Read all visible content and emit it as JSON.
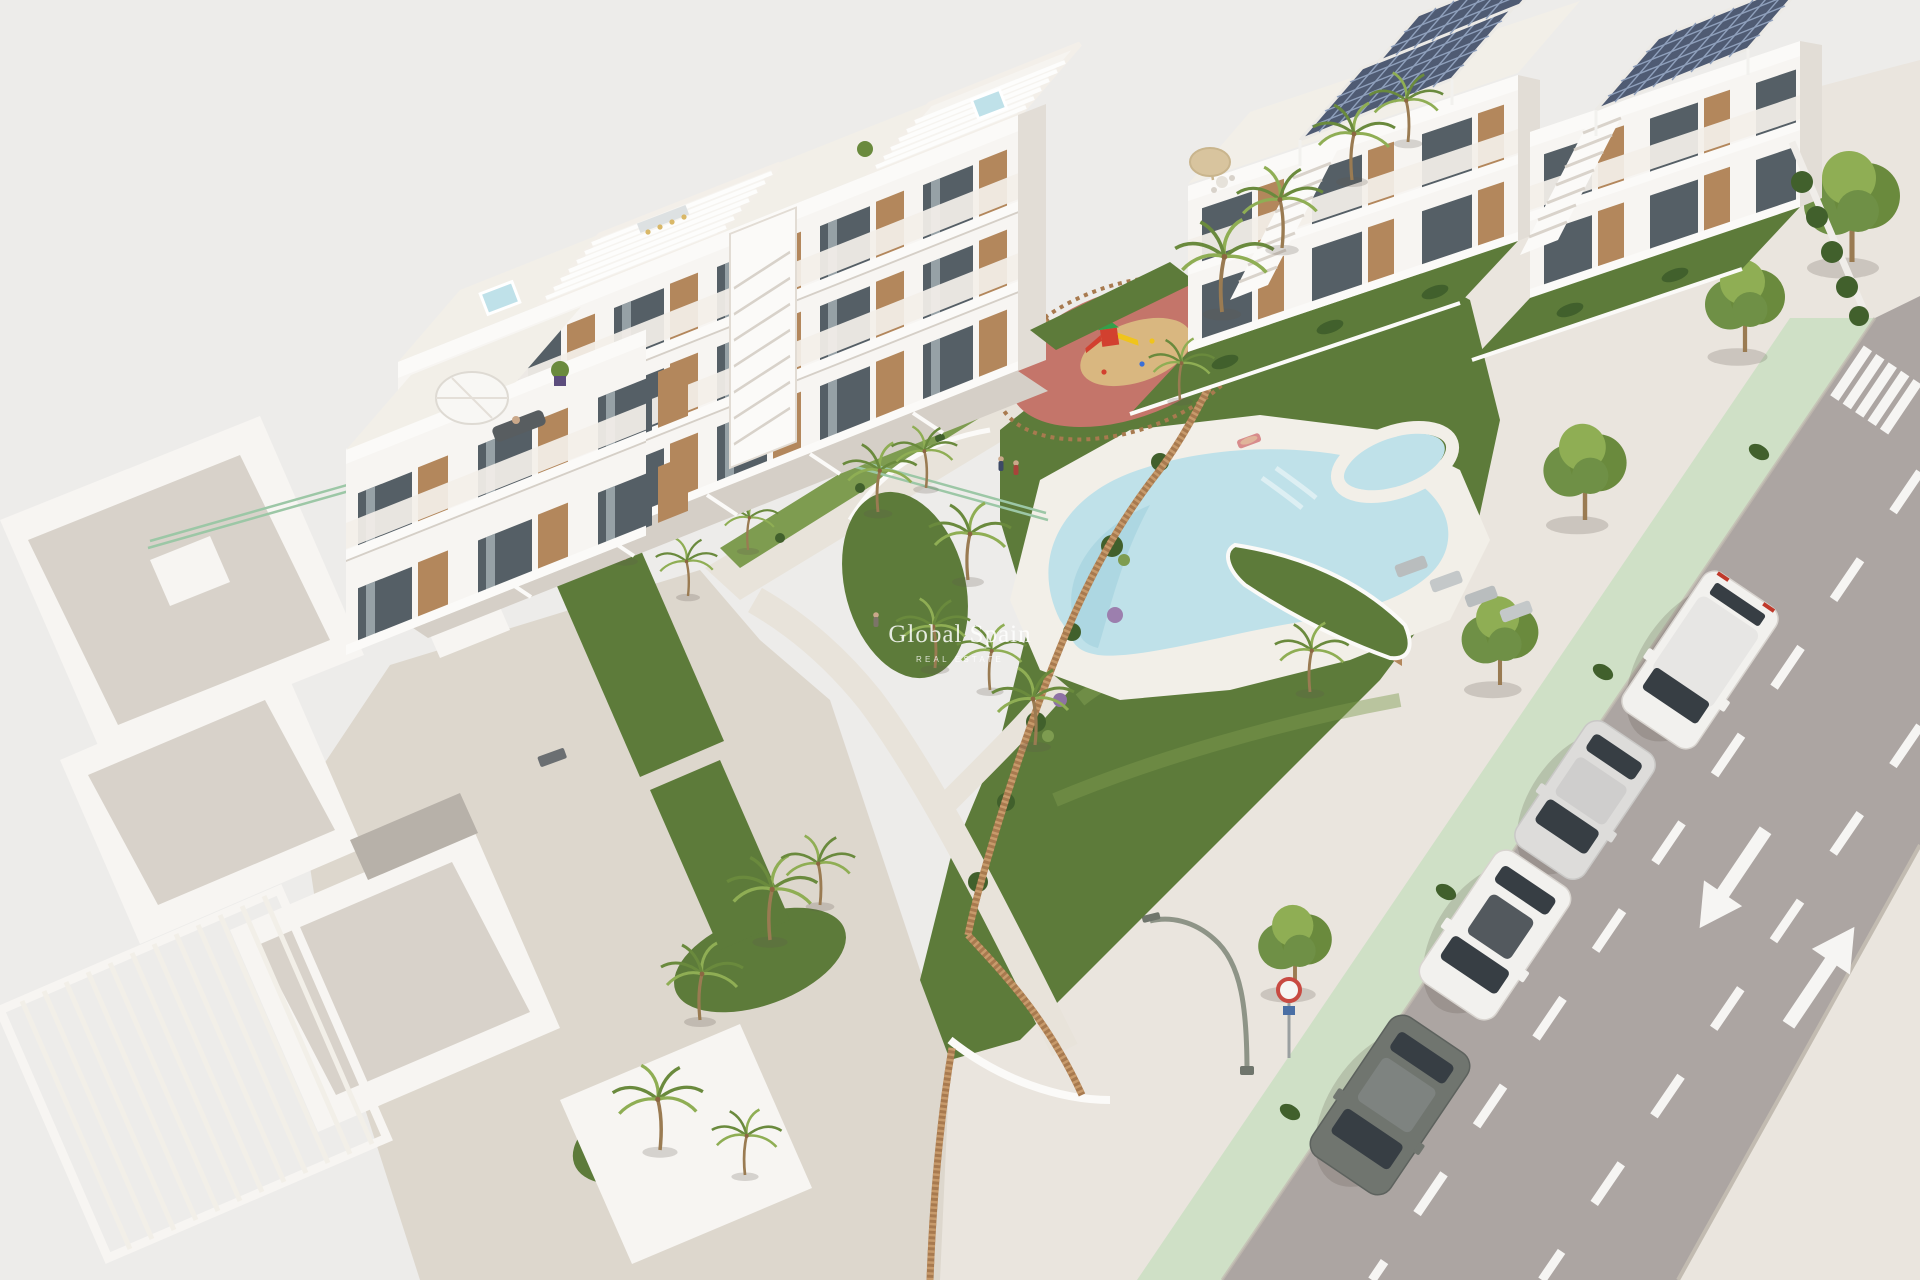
{
  "watermark": {
    "title": "Global Spain",
    "subtitle": "REAL ESTATE"
  },
  "palette": {
    "background": "#edecea",
    "building_white": "#f7f5f2",
    "building_face": "#f0ede9",
    "building_shade": "#e2ddd6",
    "building_edge": "#d5cfc7",
    "slab": "#fbfaf8",
    "railing": "#f3efe9",
    "wood": "#b3875c",
    "wood_dark": "#8c6742",
    "glass": "#555f66",
    "glass_light": "#96a1a6",
    "plaza": "#ddd7cd",
    "walkway": "#e8e3da",
    "deck": "#f2efe8",
    "tile": "#d8d2ca",
    "grass": "#5d7b3a",
    "grass_light": "#7e9c50",
    "hedge": "#41602c",
    "palm_light": "#8fae54",
    "palm_dark": "#6a8a3d",
    "trunk": "#9a7b52",
    "tree_green": "#6f9046",
    "pool": "#bfe1e9",
    "pool_deep": "#9fd0dc",
    "pool_step": "#ddeff3",
    "road": "#aca5a2",
    "road_marking": "#f6f5f3",
    "green_lane": "#cfe0c6",
    "sidewalk": "#eae5de",
    "curb": "#c2bbb1",
    "solar": "#4f5b73",
    "solar_grid": "#8fa0bc",
    "fence_wood": "#a87a4f",
    "fence_slat": "#c79a6b",
    "mesh_fence": "#9cc7a6",
    "playground_base": "#c4756a",
    "playground_sand": "#d9b780",
    "play_red": "#d2402f",
    "play_green": "#33a04a",
    "play_yellow": "#f0c41c",
    "car_white": "#f2f1ee",
    "car_silver": "#dddcda",
    "car_dark": "#70756f",
    "car_glass": "#373e44",
    "lamp": "#8e9487",
    "shadow": "rgba(95,88,78,0.22)",
    "watermark": "#ffffff"
  }
}
